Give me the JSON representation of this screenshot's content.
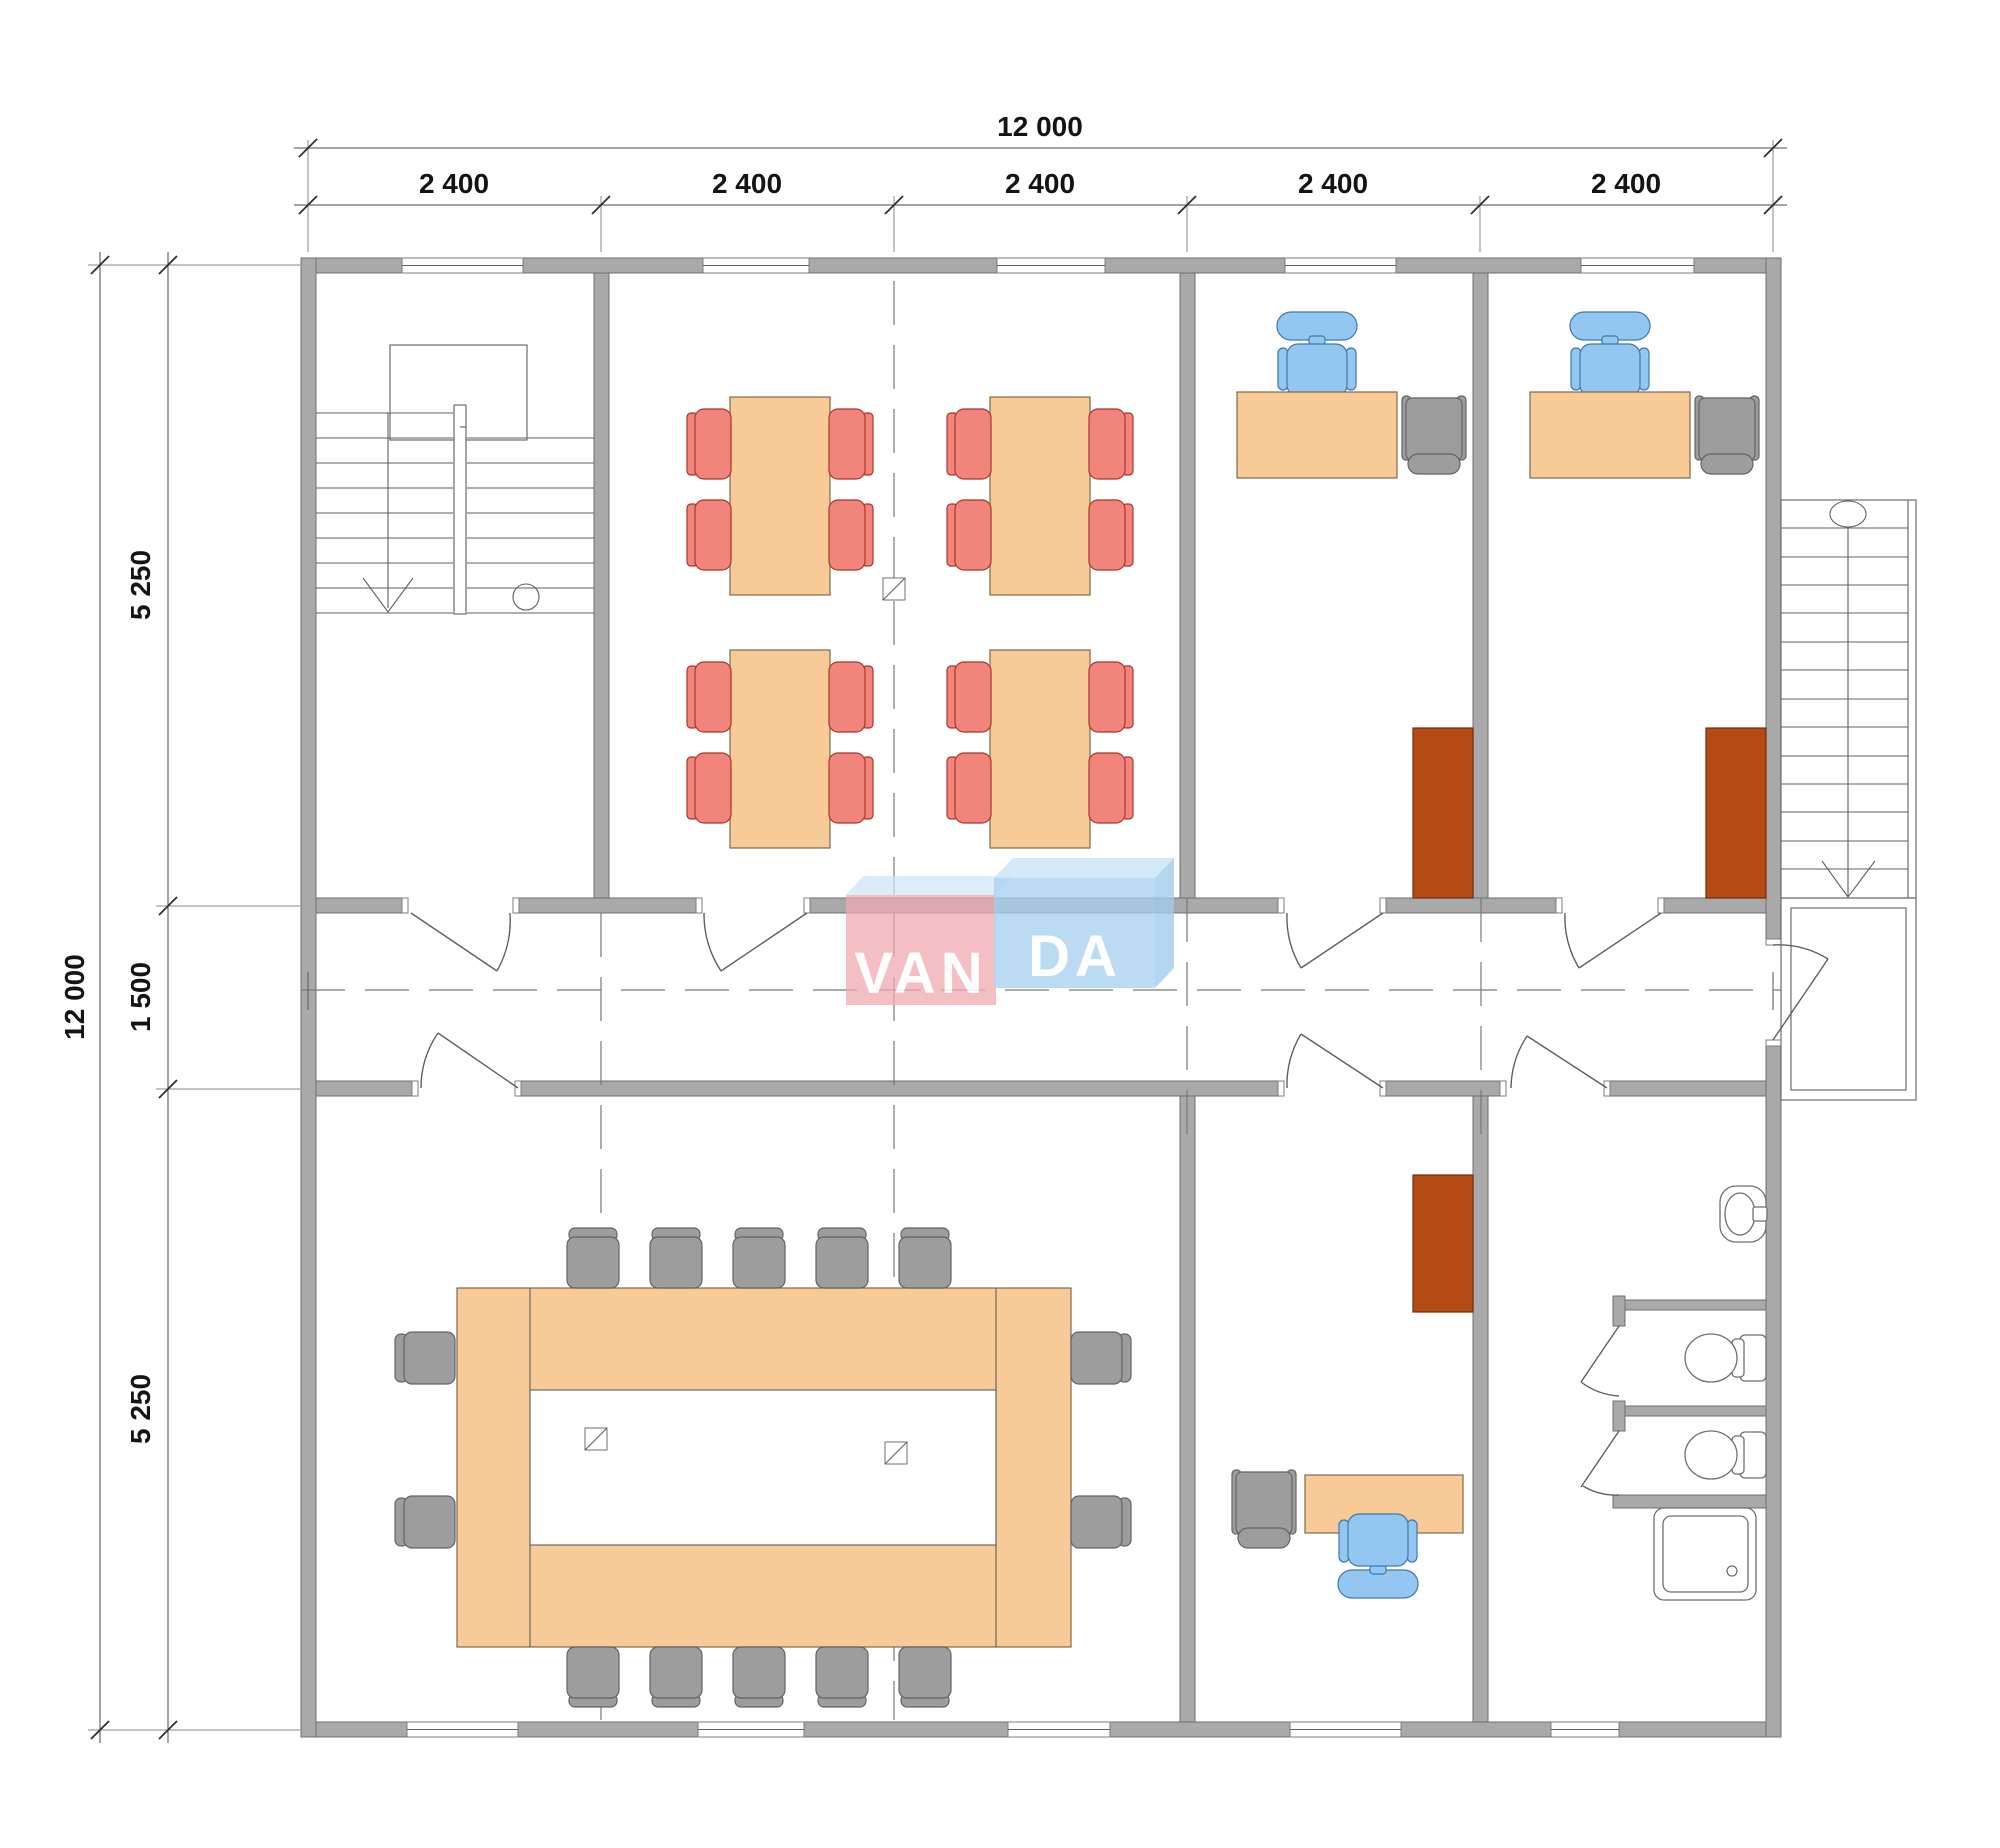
{
  "drawing": {
    "type": "architectural-floor-plan",
    "watermark": "VANDA"
  },
  "dimensions": {
    "top": {
      "total": "12 000",
      "segments": [
        "2 400",
        "2 400",
        "2 400",
        "2 400",
        "2 400"
      ]
    },
    "left": {
      "total": "12 000",
      "segments": [
        "5 250",
        "1 500",
        "5 250"
      ]
    }
  },
  "logo": {
    "text": "VANDA",
    "left": "VAN",
    "right": "DA",
    "pink_block": "#efa9b2",
    "blue_block": "#a6d0ef"
  },
  "colors": {
    "wall": "#a9a9a9",
    "table": "#f7ca97",
    "chair_red": "#f1847b",
    "chair_blue": "#93c7f1",
    "chair_gray": "#9d9d9d",
    "cabinet": "#b44b15",
    "background": "#ffffff"
  },
  "inventory": {
    "dining_tables": 4,
    "dining_chairs": 16,
    "conference_table": 1,
    "conference_chairs": 14,
    "desks": 3,
    "office_chairs": 3,
    "visitor_chairs": 3,
    "cabinets": 3,
    "toilets": 2,
    "sink": 1,
    "shower": 1,
    "staircases": 2
  }
}
